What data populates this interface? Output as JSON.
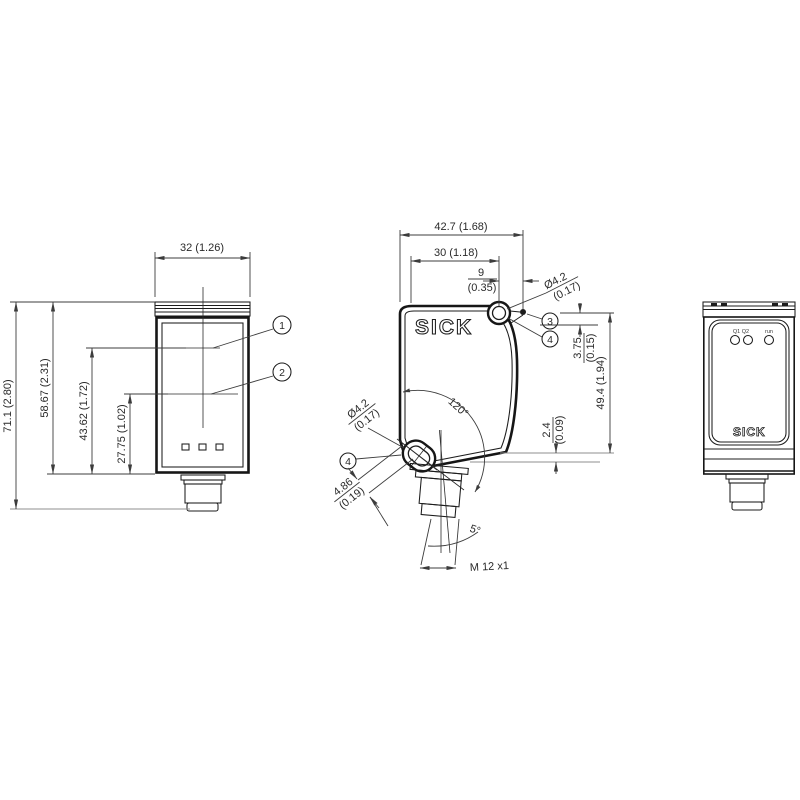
{
  "drawing": {
    "colors": {
      "outline": "#161616",
      "dimension": "#3c3c3c",
      "background": "#ffffff"
    },
    "front_view": {
      "dim_width": "32 (1.26)",
      "dim_total_height": "71.1 (2.80)",
      "dim_housing_height": "58.67 (2.31)",
      "dim_axis1_height": "43.62 (1.72)",
      "dim_axis2_height": "27.75 (1.02)",
      "callout_1": "1",
      "callout_2": "2"
    },
    "side_view": {
      "logo": "SICK",
      "dim_depth_total": "42.7 (1.68)",
      "dim_depth_hole": "30 (1.18)",
      "dim_hole_offset": "9",
      "dim_hole_offset_inch": "(0.35)",
      "dim_hole_dia": "Ø4.2",
      "dim_hole_dia_inch": "(0.17)",
      "dim_rear_step": "3.75",
      "dim_rear_step_inch": "(0.15)",
      "dim_rear_height": "49.4 (1.94)",
      "dim_bottom_step": "2.4",
      "dim_bottom_step_inch": "(0.09)",
      "angle_slot": "120°",
      "dim_slot_dia": "Ø4.2",
      "dim_slot_dia_inch": "(0.17)",
      "dim_slot_width": "4.86",
      "dim_slot_width_inch": "(0.19)",
      "angle_connector": "5°",
      "thread_label": "M 12 x1",
      "callout_3": "3",
      "callout_4": "4"
    },
    "rear_view": {
      "logo": "SICK",
      "led_q_label": "Q1 Q2",
      "led_run_label": "run"
    }
  }
}
